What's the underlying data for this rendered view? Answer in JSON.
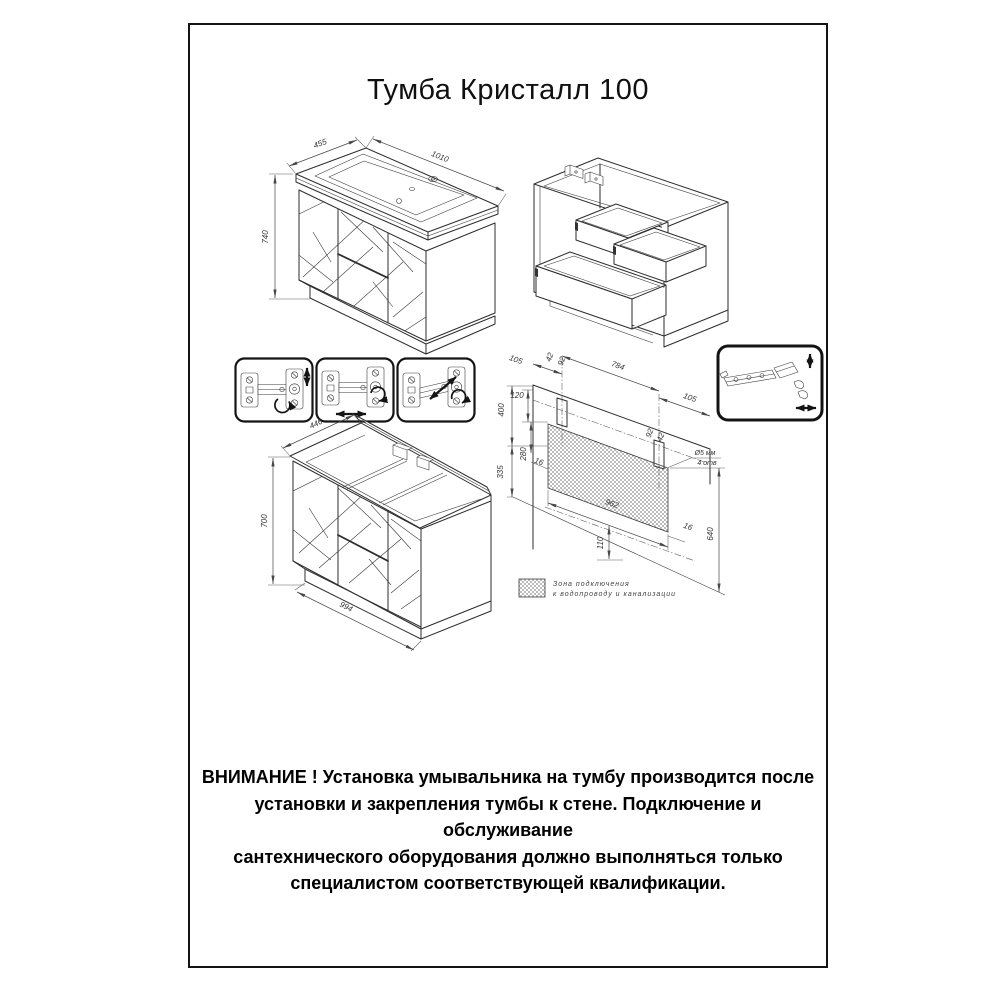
{
  "title": "Тумба Кристалл 100",
  "vanity": {
    "depth": "455",
    "width": "1010",
    "height": "740"
  },
  "cabinet": {
    "depth": "446",
    "height": "700",
    "width": "994"
  },
  "wall": {
    "offset_left": "105",
    "slot_left_a": "42",
    "slot_left_b": "92",
    "between_slots": "784",
    "offset_right": "105",
    "slot_right_a": "92",
    "slot_right_b": "42",
    "rail_to_zone": "120",
    "zone_height": "280",
    "top_height": "400",
    "bottom_height": "335",
    "gap_left": "16",
    "zone_width": "962",
    "gap_right": "16",
    "drain_offset": "110",
    "drain_height": "640",
    "hole_note_1": "Ø5 мм",
    "hole_note_2": "4 отв"
  },
  "legend": {
    "line1": "Зона подключения",
    "line2": "к водопроводу и канализации"
  },
  "warning": [
    "ВНИМАНИЕ ! Установка умывальника на тумбу производится после",
    "установки и закрепления тумбы к стене. Подключение и обслуживание",
    "сантехнического оборудования должно выполняться только",
    "специалистом соответствующей квалификации."
  ]
}
